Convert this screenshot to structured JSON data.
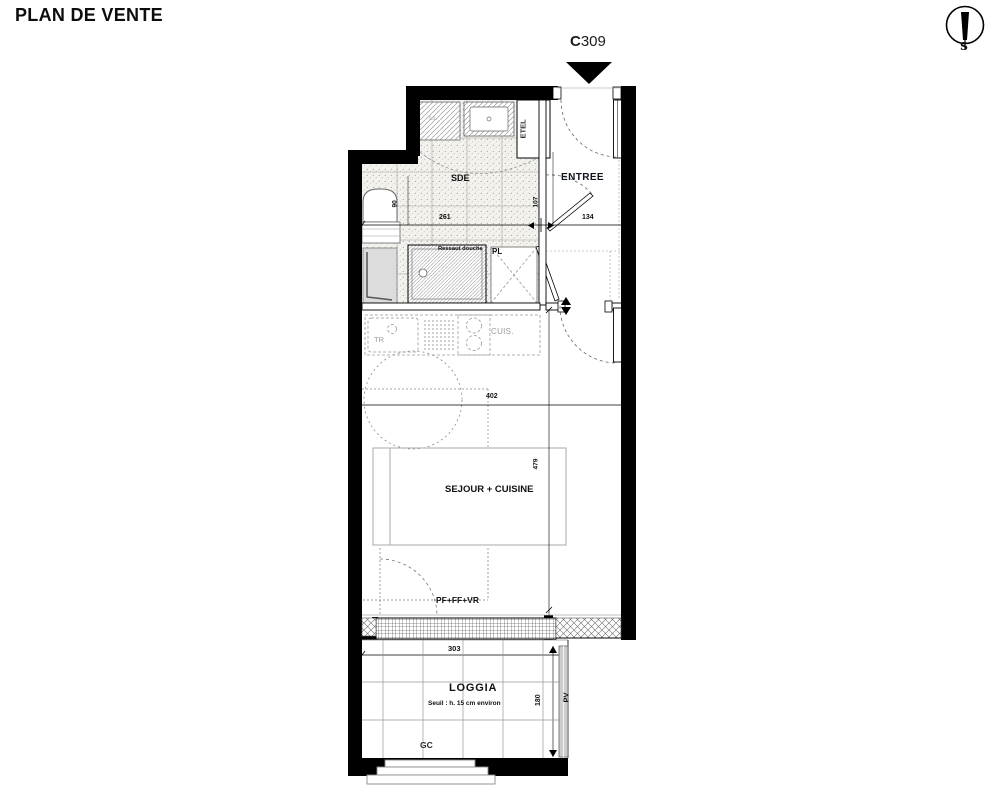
{
  "header": {
    "title": "PLAN DE VENTE"
  },
  "compass": {
    "south": "S"
  },
  "unit": {
    "prefix": "C",
    "number": "309"
  },
  "rooms": {
    "sde": "SDE",
    "entree": "ENTREE",
    "sejour_cuisine": "SEJOUR + CUISINE",
    "loggia": "LOGGIA",
    "loggia_note": "Seuil : h. 15 cm environ"
  },
  "labels": {
    "washing_machine": "LL",
    "technical_duct": "ETEL",
    "shower_step": "Ressaut douche",
    "closet": "PL",
    "sorting_bin": "TR",
    "kitchen_unit": "CUIS.",
    "window_type": "PF+FF+VR",
    "guardrail": "GC",
    "privacy_screen": "PV"
  },
  "dimensions": {
    "sde_width_cm": "261",
    "entree_width_cm": "134",
    "entree_depth_cm": "107",
    "wc_width_cm": "90",
    "sejour_width_cm": "402",
    "sejour_depth_cm": "479",
    "loggia_width_cm": "303",
    "loggia_depth_cm": "180"
  }
}
